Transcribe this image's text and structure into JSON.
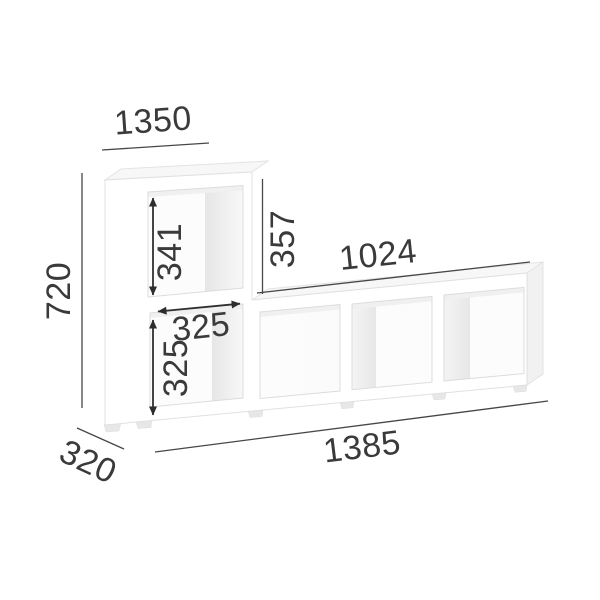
{
  "diagram": {
    "name": "shelf-unit-dimension-drawing",
    "product": "L-shaped open cube shelving unit, 5 compartments",
    "view": "perspective front view on white background",
    "dimensions": {
      "top_width": "1350",
      "overall_height": "720",
      "depth": "320",
      "overall_width": "1385",
      "top_cell_inner_height": "341",
      "upper_section_height": "357",
      "lower_row_width": "1024",
      "cell_inner_width": "325",
      "lower_cell_inner_height": "325"
    },
    "colors": {
      "background": "#ffffff",
      "dimension_line": "#474747",
      "dimension_text": "#3a3a3a",
      "shelf_face": "#ffffff",
      "shelf_edge": "#e0e0e0",
      "shelf_top_face": "#f7f7f7",
      "inner_wall": "#e8e8e8"
    }
  }
}
